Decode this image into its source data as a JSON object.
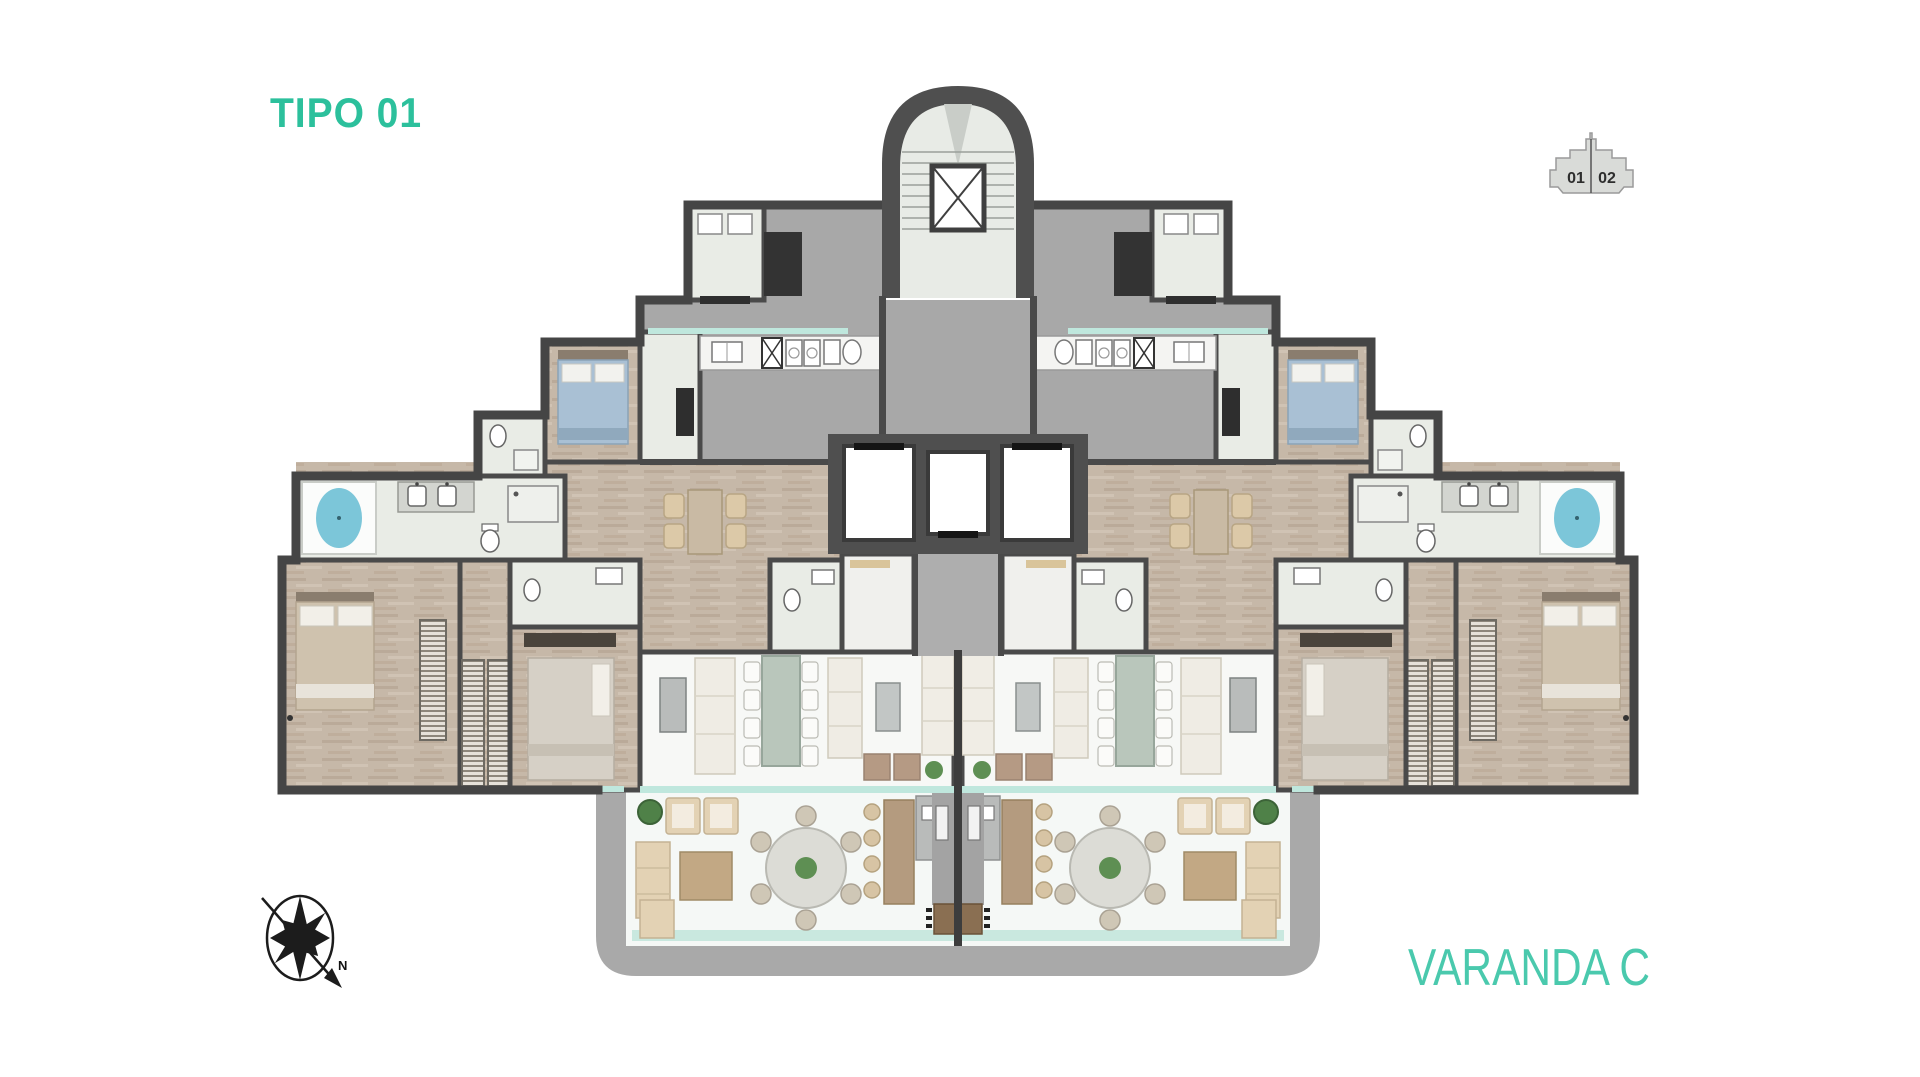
{
  "header": {
    "plan_type_label": "TIPO 01",
    "accent_color": "#2cc09c"
  },
  "key_plan": {
    "unit_left_label": "01",
    "unit_right_label": "02",
    "fill_color": "#d9dbd8"
  },
  "compass": {
    "north_label": "N"
  },
  "footer": {
    "balcony_label": "VARANDA C",
    "accent_color": "#4ac9ad"
  },
  "palette": {
    "wall": "#4a4a4a",
    "room_light_floor": "#e9ece6",
    "service_gray_floor": "#a8a8a8",
    "wood_floor": "#c6b8a8",
    "balcony_floor": "#f5f8f6",
    "pool_water": "#7cc6d9",
    "glass_window": "#bfe7dd",
    "furniture_beige": "#e3d2b4",
    "furniture_cream": "#efece4",
    "plant_green": "#5e8f53"
  }
}
